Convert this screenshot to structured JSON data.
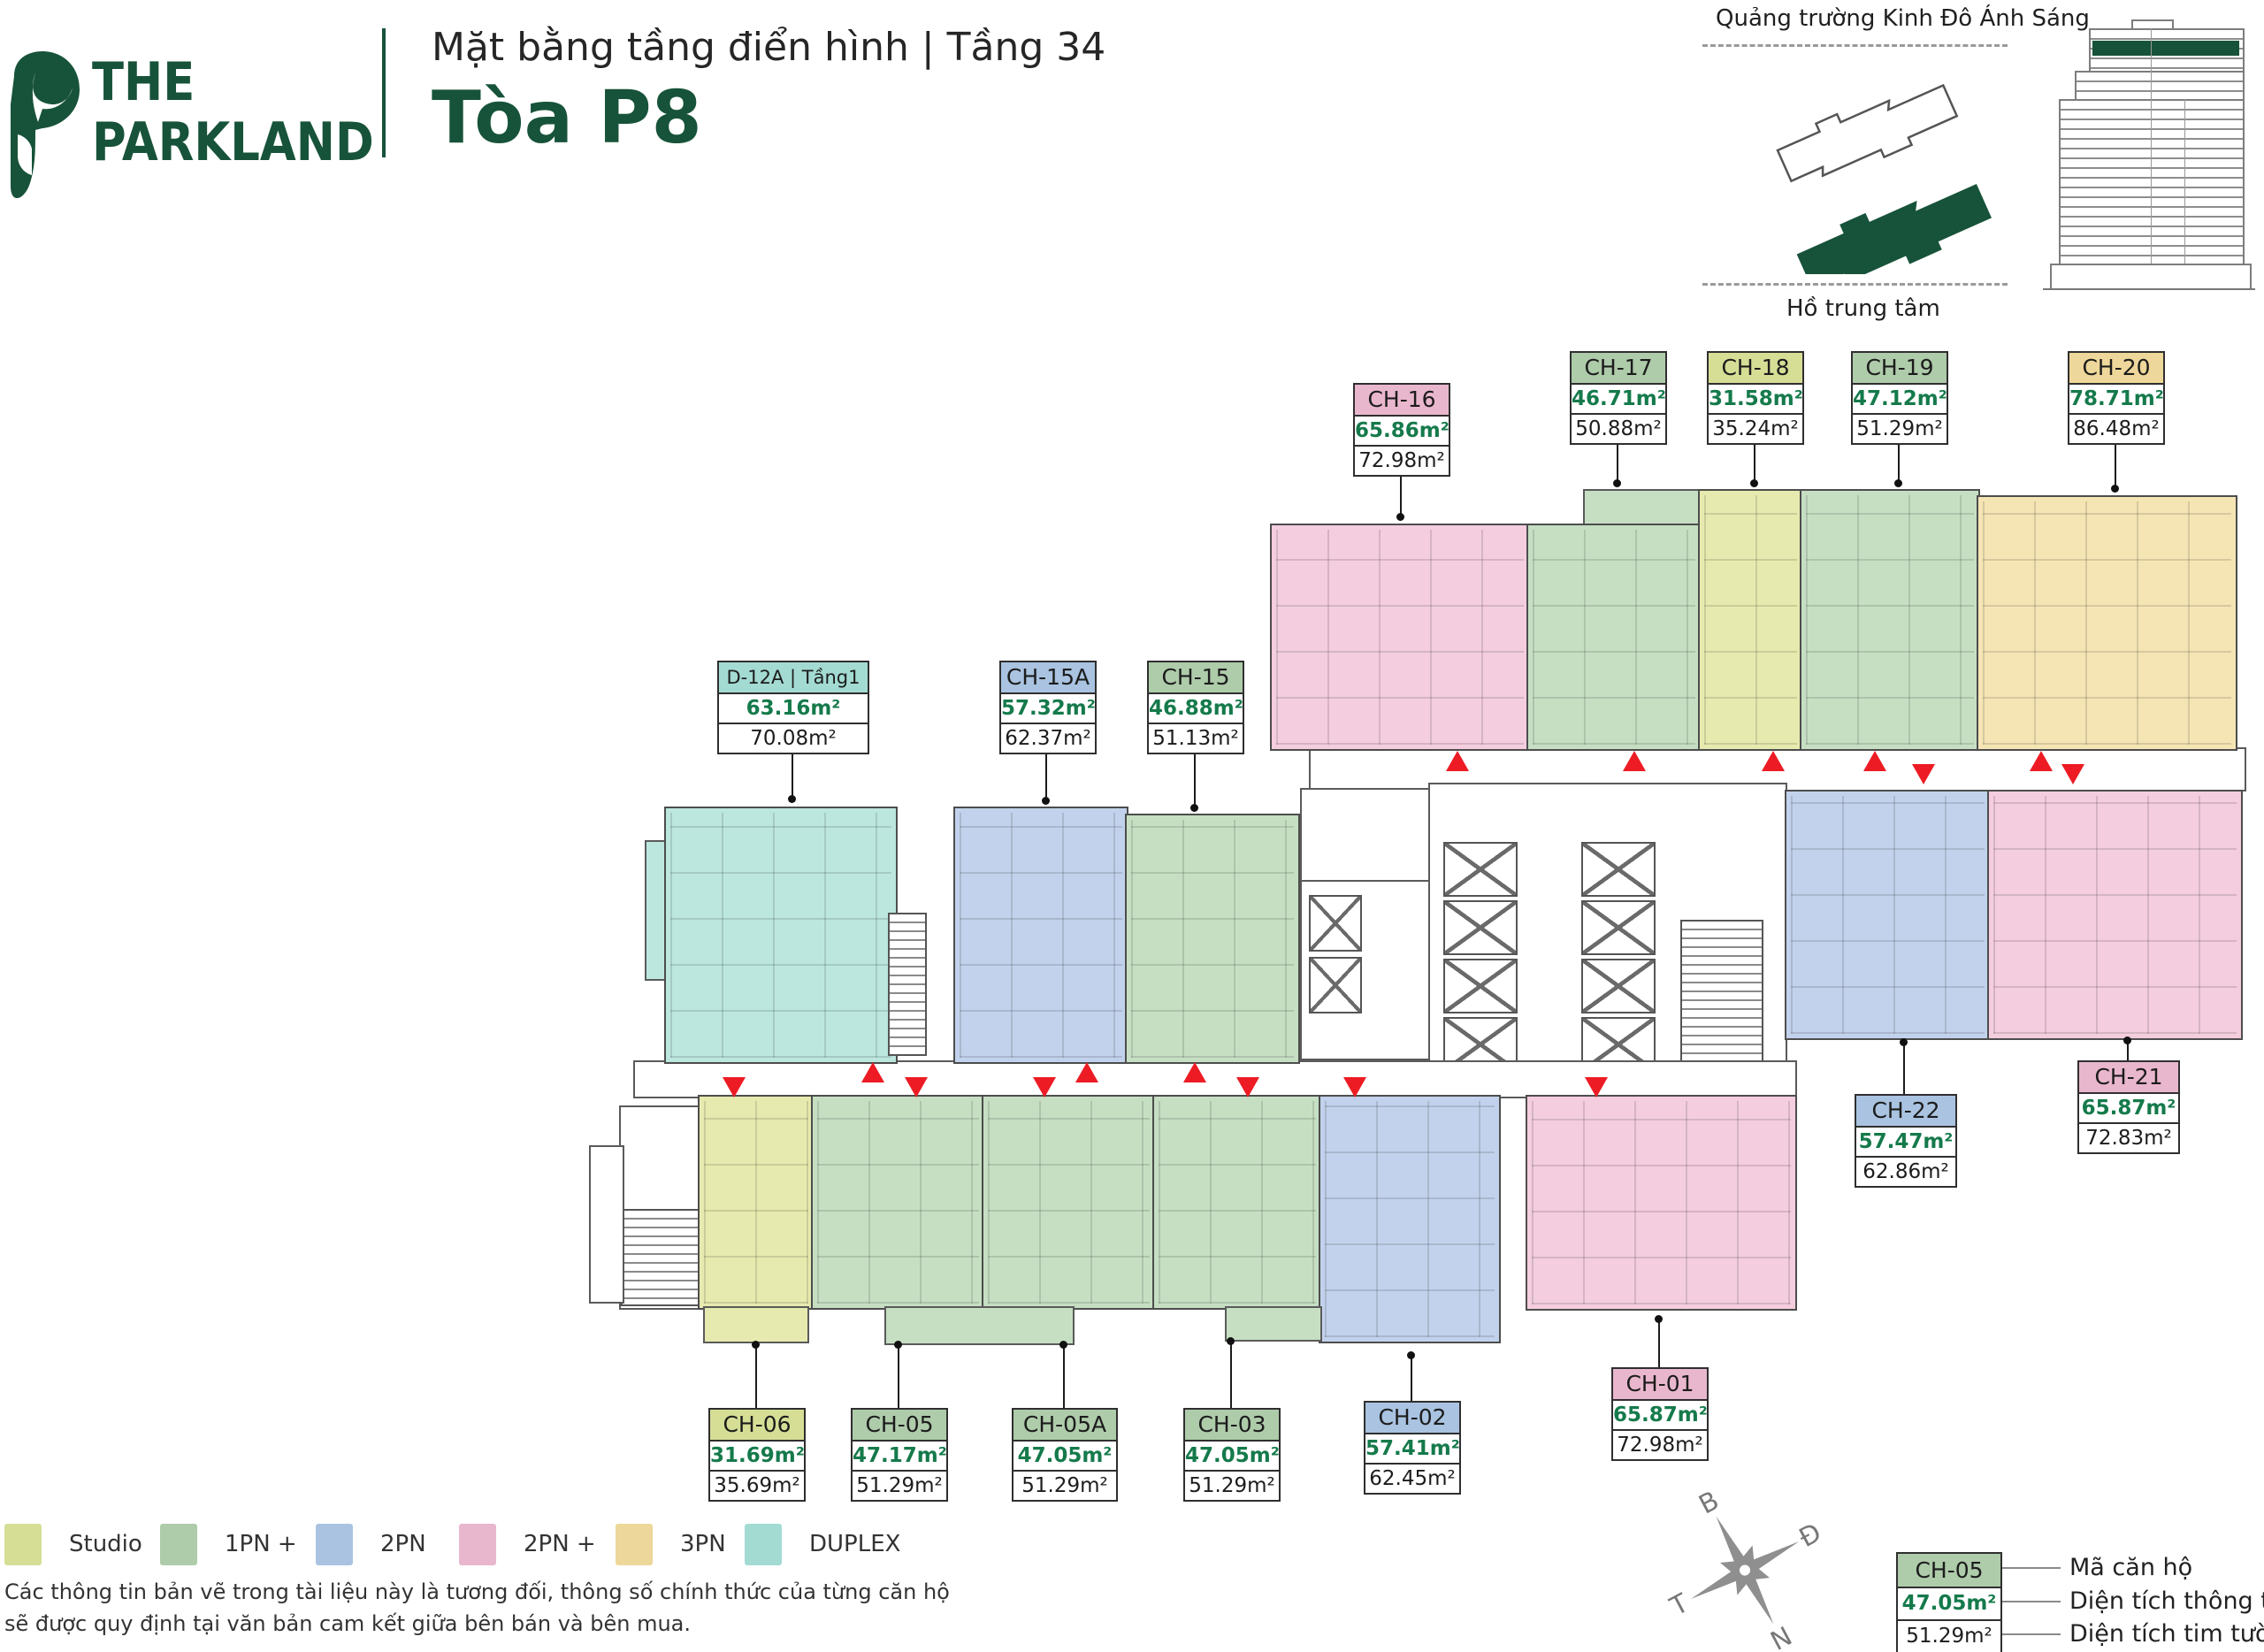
{
  "header": {
    "brand_line1": "THE",
    "brand_line2": "PARKLAND",
    "subtitle": "Mặt bằng tầng điển hình | Tầng 34",
    "tower": "Tòa P8"
  },
  "site_map": {
    "top_label": "Quảng trường Kinh Đô Ánh Sáng",
    "bottom_label": "Hồ trung tâm"
  },
  "type_colors": {
    "studio": "#d6de96",
    "1pn": "#aecbaa",
    "2pn": "#a9c3e1",
    "2pnp": "#e9b7cd",
    "3pn": "#eed79a",
    "duplex": "#a3dbd3"
  },
  "legend": [
    {
      "label": "Studio",
      "type": "studio"
    },
    {
      "label": "1PN +",
      "type": "1pn"
    },
    {
      "label": "2PN",
      "type": "2pn"
    },
    {
      "label": "2PN +",
      "type": "2pnp"
    },
    {
      "label": "3PN",
      "type": "3pn"
    },
    {
      "label": "DUPLEX",
      "type": "duplex"
    }
  ],
  "units": [
    {
      "code": "CH-16",
      "net": "65.86m²",
      "gross": "72.98m²",
      "type": "2pnp"
    },
    {
      "code": "CH-17",
      "net": "46.71m²",
      "gross": "50.88m²",
      "type": "1pn"
    },
    {
      "code": "CH-18",
      "net": "31.58m²",
      "gross": "35.24m²",
      "type": "studio"
    },
    {
      "code": "CH-19",
      "net": "47.12m²",
      "gross": "51.29m²",
      "type": "1pn"
    },
    {
      "code": "CH-20",
      "net": "78.71m²",
      "gross": "86.48m²",
      "type": "3pn"
    },
    {
      "code": "D-12A | Tầng1",
      "net": "63.16m²",
      "gross": "70.08m²",
      "type": "duplex"
    },
    {
      "code": "CH-15A",
      "net": "57.32m²",
      "gross": "62.37m²",
      "type": "2pn"
    },
    {
      "code": "CH-15",
      "net": "46.88m²",
      "gross": "51.13m²",
      "type": "1pn"
    },
    {
      "code": "CH-22",
      "net": "57.47m²",
      "gross": "62.86m²",
      "type": "2pn"
    },
    {
      "code": "CH-21",
      "net": "65.87m²",
      "gross": "72.83m²",
      "type": "2pnp"
    },
    {
      "code": "CH-06",
      "net": "31.69m²",
      "gross": "35.69m²",
      "type": "studio"
    },
    {
      "code": "CH-05",
      "net": "47.17m²",
      "gross": "51.29m²",
      "type": "1pn"
    },
    {
      "code": "CH-05A",
      "net": "47.05m²",
      "gross": "51.29m²",
      "type": "1pn"
    },
    {
      "code": "CH-03",
      "net": "47.05m²",
      "gross": "51.29m²",
      "type": "1pn"
    },
    {
      "code": "CH-02",
      "net": "57.41m²",
      "gross": "62.45m²",
      "type": "2pn"
    },
    {
      "code": "CH-01",
      "net": "65.87m²",
      "gross": "72.98m²",
      "type": "2pnp"
    }
  ],
  "disclaimer_line1": "Các thông tin bản vẽ trong tài liệu này là tương đối, thông số chính thức của từng căn hộ",
  "disclaimer_line2": "sẽ được quy định tại văn bản cam kết giữa bên bán và bên mua.",
  "compass": {
    "north": "B",
    "east": "Đ",
    "south": "N",
    "west": "T"
  },
  "key_example": {
    "code": "CH-05",
    "net": "47.05m²",
    "gross": "51.29m²",
    "row_labels": [
      "Mã căn hộ",
      "Diện tích thông thủy",
      "Diện tích tim tường"
    ]
  }
}
